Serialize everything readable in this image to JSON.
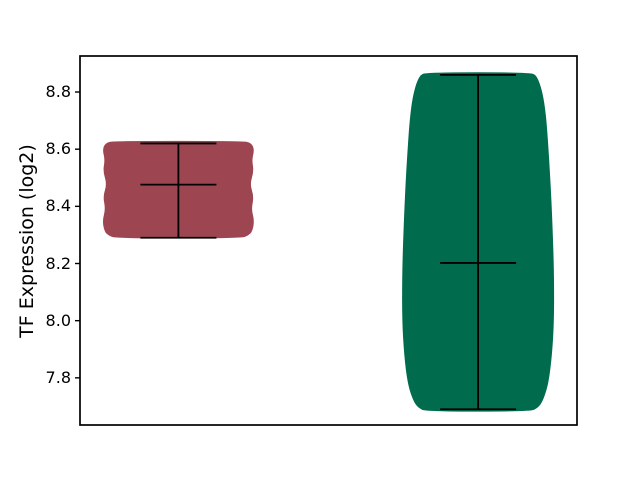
{
  "figure": {
    "background_color": "#ffffff",
    "axes_edge_color": "#000000"
  },
  "chart_data": {
    "type": "violin",
    "title": "",
    "xlabel": "",
    "ylabel": "TF Expression (log2)",
    "yticks": [
      8.8,
      8.6,
      8.4,
      8.2,
      8.0,
      7.8
    ],
    "ytick_labels": [
      "8.8",
      "8.6",
      "8.4",
      "8.2",
      "8.0",
      "7.8"
    ],
    "ylim": [
      7.635,
      8.926
    ],
    "xticks_visible": false,
    "grid": false,
    "legend": null,
    "marker_color": "#000000",
    "series": [
      {
        "name": "violin-1",
        "fill_color": "#9e4552",
        "center_frac": 0.198,
        "max": 8.62,
        "min": 8.29,
        "median": 8.476,
        "profile": [
          [
            8.629,
            64
          ],
          [
            8.622,
            73
          ],
          [
            8.598,
            76
          ],
          [
            8.563,
            73.5
          ],
          [
            8.523,
            75.5
          ],
          [
            8.477,
            71.5
          ],
          [
            8.435,
            75.5
          ],
          [
            8.39,
            73
          ],
          [
            8.35,
            76
          ],
          [
            8.312,
            74
          ],
          [
            8.298,
            70
          ],
          [
            8.288,
            63
          ]
        ]
      },
      {
        "name": "violin-2",
        "fill_color": "#006b4d",
        "center_frac": 0.801,
        "max": 8.86,
        "min": 7.69,
        "median": 8.202,
        "profile": [
          [
            8.869,
            52
          ],
          [
            8.857,
            59
          ],
          [
            8.8,
            64.5
          ],
          [
            8.72,
            68
          ],
          [
            8.6,
            70.5
          ],
          [
            8.45,
            73
          ],
          [
            8.28,
            75
          ],
          [
            8.15,
            76
          ],
          [
            8.0,
            76
          ],
          [
            7.88,
            74
          ],
          [
            7.78,
            70.5
          ],
          [
            7.72,
            65
          ],
          [
            7.695,
            60
          ],
          [
            7.682,
            52
          ]
        ]
      }
    ]
  }
}
